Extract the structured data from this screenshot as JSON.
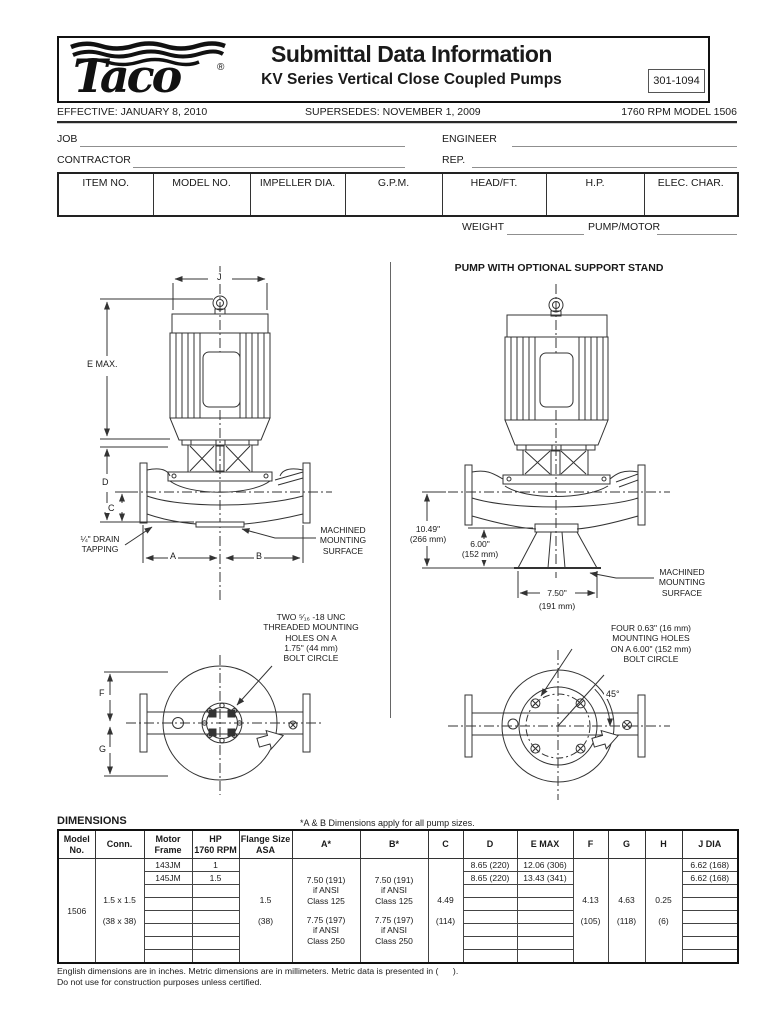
{
  "header": {
    "brand": "Taco",
    "registered": "®",
    "title": "Submittal Data Information",
    "subtitle": "KV Series Vertical Close Coupled Pumps",
    "doc_number": "301-1094",
    "effective": "EFFECTIVE: JANUARY 8, 2010",
    "supersedes": "SUPERSEDES: NOVEMBER 1, 2009",
    "model_rpm": "1760 RPM MODEL 1506"
  },
  "form": {
    "job": "JOB",
    "engineer": "ENGINEER",
    "contractor": "CONTRACTOR",
    "rep": "REP.",
    "weight": "WEIGHT",
    "pump_motor": "PUMP/MOTOR"
  },
  "spec_table": {
    "headers": [
      "ITEM NO.",
      "MODEL NO.",
      "IMPELLER DIA.",
      "G.P.M.",
      "HEAD/FT.",
      "H.P.",
      "ELEC. CHAR."
    ]
  },
  "drawings": {
    "front_view": {
      "dim_j": "J",
      "dim_e": "E MAX.",
      "dim_d": "D",
      "dim_c": "C",
      "dim_a": "A",
      "dim_b": "B",
      "drain_line1": "¼\" DRAIN",
      "drain_line2": "TAPPING",
      "mount_line1": "MACHINED",
      "mount_line2": "MOUNTING",
      "mount_line3": "SURFACE"
    },
    "stand_view": {
      "title": "PUMP WITH  OPTIONAL SUPPORT STAND",
      "dim1_in": "10.49\"",
      "dim1_mm": "(266 mm)",
      "dim2_in": "6.00\"",
      "dim2_mm": "(152 mm)",
      "dim3_in": "7.50\"",
      "dim3_mm": "(191 mm)",
      "mount_line1": "MACHINED",
      "mount_line2": "MOUNTING",
      "mount_line3": "SURFACE"
    },
    "top_view": {
      "note_line1": "TWO ⁵⁄₁₆ -18 UNC",
      "note_line2": "THREADED MOUNTING",
      "note_line3": "HOLES ON A",
      "note_line4": "1.75\" (44 mm)",
      "note_line5": "BOLT CIRCLE",
      "dim_f": "F",
      "dim_g": "G"
    },
    "stand_top_view": {
      "note_line1": "FOUR 0.63\" (16 mm)",
      "note_line2": "MOUNTING HOLES",
      "note_line3": "ON A 6.00\" (152 mm)",
      "note_line4": "BOLT CIRCLE",
      "angle": "45°"
    }
  },
  "dimensions": {
    "title": "DIMENSIONS",
    "note": "*A & B Dimensions apply for all pump sizes.",
    "headers": [
      "Model\nNo.",
      "Conn.",
      "Motor\nFrame",
      "HP\n1760 RPM",
      "Flange Size\nASA",
      "A*",
      "B*",
      "C",
      "D",
      "E MAX",
      "F",
      "G",
      "H",
      "J DIA"
    ],
    "model_no": "1506",
    "conn_in": "1.5 x 1.5",
    "conn_mm": "(38 x 38)",
    "flange_in": "1.5",
    "flange_mm": "(38)",
    "a_block1": "7.50 (191)\nif ANSI\nClass 125",
    "a_block2": "7.75 (197)\nif ANSI\nClass 250",
    "b_block1": "7.50 (191)\nif ANSI\nClass 125",
    "b_block2": "7.75 (197)\nif ANSI\nClass 250",
    "c_in": "4.49",
    "c_mm": "(114)",
    "f_in": "4.13",
    "f_mm": "(105)",
    "g_in": "4.63",
    "g_mm": "(118)",
    "h_in": "0.25",
    "h_mm": "(6)",
    "rows": [
      {
        "frame": "143JM",
        "hp": "1",
        "d": "8.65 (220)",
        "emax": "12.06 (306)",
        "jdia": "6.62 (168)"
      },
      {
        "frame": "145JM",
        "hp": "1.5",
        "d": "8.65 (220)",
        "emax": "13.43 (341)",
        "jdia": "6.62 (168)"
      },
      {
        "frame": "",
        "hp": "",
        "d": "",
        "emax": "",
        "jdia": ""
      },
      {
        "frame": "",
        "hp": "",
        "d": "",
        "emax": "",
        "jdia": ""
      },
      {
        "frame": "",
        "hp": "",
        "d": "",
        "emax": "",
        "jdia": ""
      },
      {
        "frame": "",
        "hp": "",
        "d": "",
        "emax": "",
        "jdia": ""
      },
      {
        "frame": "",
        "hp": "",
        "d": "",
        "emax": "",
        "jdia": ""
      },
      {
        "frame": "",
        "hp": "",
        "d": "",
        "emax": "",
        "jdia": ""
      }
    ]
  },
  "footer": {
    "line1": "English dimensions are in inches. Metric dimensions are in millimeters. Metric data is presented in (      ).",
    "line2": "Do not use for construction purposes unless certified."
  }
}
